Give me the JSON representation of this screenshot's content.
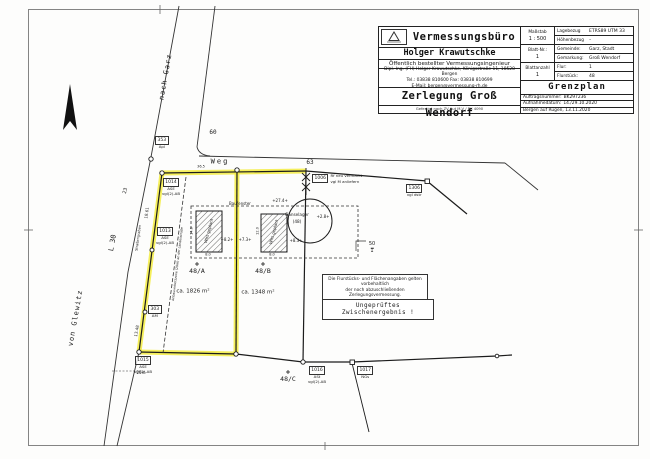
{
  "colors": {
    "highlight": "#f3ec3f",
    "ink": "#1b1b1b",
    "paper": "#fdfdfc"
  },
  "title_block": {
    "office": "Vermessungsbüro",
    "name": "Holger Krawutschke",
    "subtitle": "Öffentlich bestellter Vermessungsingenieur",
    "address_line1": "Dipl.-Ing. (FH) Holger Krawutschke, Königsstraße 11, 18528 Bergen",
    "address_line2": "Tel.: 03838 810600    Fax: 03838 810699",
    "address_line3": "E-Mail: bergen@vermessung-rh.de",
    "project": "Zerlegung Groß Wendorf",
    "footnote": "Gefertigt nach ZV-Aut M-V / BK 4090",
    "scale_label": "Maßstab",
    "scale_value": "1 : 500",
    "sheet_no_label": "Blatt-Nr.:",
    "sheet_no_value": "1",
    "sheet_count_label": "Blattanzahl",
    "sheet_count_value": "1",
    "ref_label": "Lagebezug",
    "ref_value": "ETRS89 UTM 33",
    "height_ref_label": "Höhenbezug",
    "height_ref_value": "–",
    "municipality_label": "Gemeinde:",
    "municipality_value": "Garz, Stadt",
    "district_label": "Gemarkung:",
    "district_value": "Groß Wendorf",
    "flur_label": "Flur:",
    "flur_value": "1",
    "parcel_label": "Flurstück:",
    "parcel_value": "48",
    "doc_type": "Grenzplan",
    "order_label": "Auftragsnummer:",
    "order_value": "BK297236",
    "survey_date_label": "Aufnahmedatum:",
    "survey_date_value": "14./29.10.2020",
    "place_date": "Bergen auf Rügen, 13.11.2020"
  },
  "notes": {
    "disclaimer_line1": "Die Flurstücks- und Flächenangaben gelten vorbehaltlich",
    "disclaimer_line2": "der noch abzuschließenden Zerlegungsvermessung.",
    "interim": "Ungeprüftes Zwischenergebnis !"
  },
  "map": {
    "road_labels": {
      "weg": "Weg",
      "weg_number": "63",
      "nach_garz": "nach Garz",
      "l30": "L 30",
      "von_glewitz": "von Glewitz",
      "strassengraben": "Straßengraben",
      "num_60": "60",
      "num_23": "23"
    },
    "parcels": {
      "a_label": "48/A",
      "a_area": "ca. 1826 m²",
      "b_label": "48/B",
      "b_area": "ca. 1348 m²",
      "c_label": "48/C",
      "neighbor_top": "50",
      "neighbor_bottom": "1"
    },
    "buildings": {
      "label_1": "Whs geplant",
      "label_2": "Whs geplant",
      "baufenster": "Baufenster",
      "gaenselager_line1": "Gänselager",
      "gaenselager_line2": "(48)"
    },
    "dimensions": {
      "top_width": "+27.4+",
      "gap_left": "+8.2+",
      "gap_mid": "+7.3+",
      "gap_right": "+8.3+",
      "offset": "+2.8+",
      "b1_width": "8.0",
      "b2_width": "8.0",
      "b1_height": "14.0",
      "b2_height": "12.0",
      "edge_upper": "18.61",
      "edge_lower": "13.48",
      "road_front": "36.5",
      "zone_depth": "20m"
    },
    "zone_text": "Anbauverbotszone (20m) an der Landesstraße",
    "point_labels": [
      {
        "id": "353",
        "lines": [
          "Apl"
        ]
      },
      {
        "id": "1014",
        "lines": [
          "ASE",
          "vgl(2)-AB"
        ]
      },
      {
        "id": "1013",
        "lines": [
          "ASE",
          "vgl(2)-AB"
        ]
      },
      {
        "id": "303",
        "lines": [
          "AM"
        ]
      },
      {
        "id": "1015",
        "lines": [
          "ASE",
          "vgl(2)-AB"
        ]
      },
      {
        "id": "1016",
        "lines": [
          "ASt",
          "vgl(2)-AB"
        ]
      },
      {
        "id": "1017",
        "lines": [
          "NGs"
        ]
      },
      {
        "id": "1006",
        "lines": [
          "Rf neu vermarkt",
          "vgl M anliefern"
        ]
      },
      {
        "id": "1306",
        "lines": [
          "vgl dstr"
        ]
      }
    ]
  }
}
